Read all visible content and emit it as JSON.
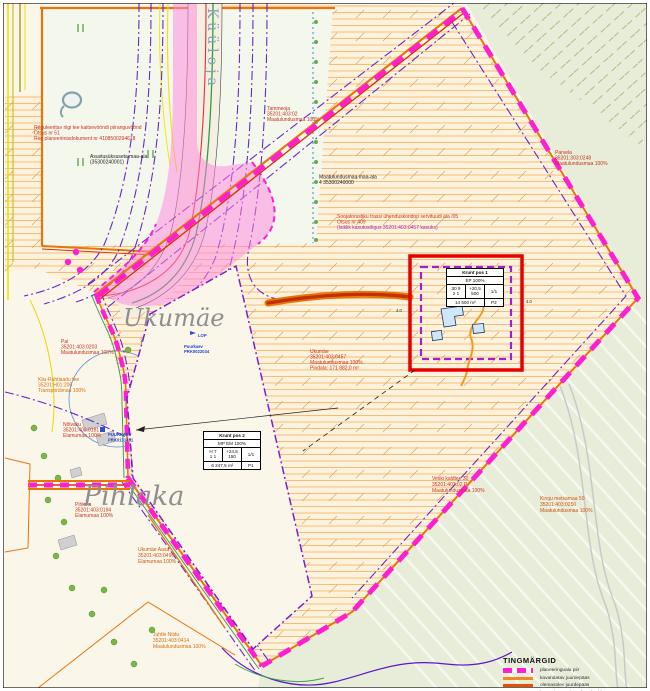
{
  "map": {
    "places": {
      "kuuloja": "Küüloja",
      "ukumae": "Ukumäe",
      "pihlaka": "Pihlaka"
    },
    "labels": {
      "restriction_note": {
        "l1": "Reguleeritav riigi tee kaitsevööndi piiranguvöönd",
        "l2": "Otsus nr 51",
        "l3": "Reg planeerimisdokument nr 4108500294618"
      },
      "state_land": {
        "l1": "Asustusüksuseta maa-ala",
        "l2": "(35300240001)"
      },
      "tammeoja": {
        "l1": "Tammeoja",
        "l2": "35201:403:02",
        "l3": "Maatulundusmaa 100%"
      },
      "maatulundus_note": {
        "l1": "Maatulundusmaa maa-ala",
        "l2": "4 35300240000"
      },
      "servituut_note": {
        "l1": "Soojatorustiku trassi ühenduskoridori servituudi ala /05",
        "l2": "Otsus nr 409",
        "l3": "(Isiklik kasutusõigus 35201:403:0457 kasuks)"
      },
      "parvela": {
        "l1": "Parvela",
        "l2": "35201:303:0248",
        "l3": "Maatulundusmaa 100%"
      },
      "ukumae_parcel": {
        "l1": "Ukumäe",
        "l2": "35201:403:0457",
        "l3": "Maatulundusmaa 100%",
        "l4": "Pindala: 171 882,0 m²"
      },
      "pai": {
        "l1": "Pai",
        "l2": "35201:403:0203",
        "l3": "Maatulundusmaa 100%"
      },
      "kiiu_tee": {
        "l1": "Kiiu-Ruhtlaadu tee",
        "l2": "35201:H01:206",
        "l3": "Transpordimaa 100%"
      },
      "nolvaku": {
        "l1": "Nõlvaku",
        "l2": "35201:403:0181",
        "l3": "Elamumaa 100%"
      },
      "puurkaev1": {
        "l1": "PUURKAEV",
        "l2": "PRK0131451"
      },
      "puurkaev2": {
        "l1": "LOP",
        "l2": "Puurkaev",
        "l3": "PRK0022034"
      },
      "pihlaka_parcel": {
        "l1": "Pihlaka",
        "l2": "35201:403:0194",
        "l3": "Elamumaa 100%"
      },
      "ukumae_aasa": {
        "l1": "Ukumäe Aasa",
        "l2": "35201:403:0496",
        "l3": "Elamumaa 100%"
      },
      "juhtle_niidu": {
        "l1": "Juhtle Niidu",
        "l2": "35201:403:0414",
        "l3": "Maatulundusmaa 100%"
      },
      "veski": {
        "l1": "Veski kaldtee 30",
        "l2": "35201:403:02 P",
        "l3": "Maatulundusmaa 100%"
      },
      "kingu": {
        "l1": "Kingu metsamaa 50",
        "l2": "35201:403:0250",
        "l3": "Maatulundusmaa 100%"
      },
      "dim_left": "4.0",
      "dim_right": "4.0"
    },
    "tables": {
      "krunt1": {
        "title": "Krunt pos 1",
        "use": "EP 100%",
        "c1a": "30 9",
        "c1b": "2 1",
        "c2a": "+20,5",
        "c2b": "500",
        "c3": "1/1",
        "area": "14 500 m²",
        "pos": "P2"
      },
      "krunt2": {
        "title": "Krunt pos 2",
        "use": "MP EM 100%",
        "c1a": "H 7",
        "c1b": "1 1",
        "c2a": "+24,5",
        "c2b": "150",
        "c3": "1/1",
        "area": "6 247,5 m²",
        "pos": "P1"
      }
    },
    "legend": {
      "title": "TINGMÄRGID",
      "items": [
        {
          "label": "planeeringuala piir"
        },
        {
          "label": "kavandatav juurdepääs"
        },
        {
          "label": "olemasolev juurdepääs"
        },
        {
          "label": "kavandatav tehnovõrgu koridor"
        }
      ]
    },
    "colors": {
      "boundary_magenta": "#ff1fd0",
      "road_orange": "#e8750a",
      "road_red": "#e03131",
      "utility_purple": "#5a18c8",
      "plot_red": "#e60000",
      "hatch_orange": "#f0a452",
      "green_area": "#e7edd8",
      "pink_zone": "#ff86e0",
      "water_blue": "#4a7ad0"
    }
  }
}
